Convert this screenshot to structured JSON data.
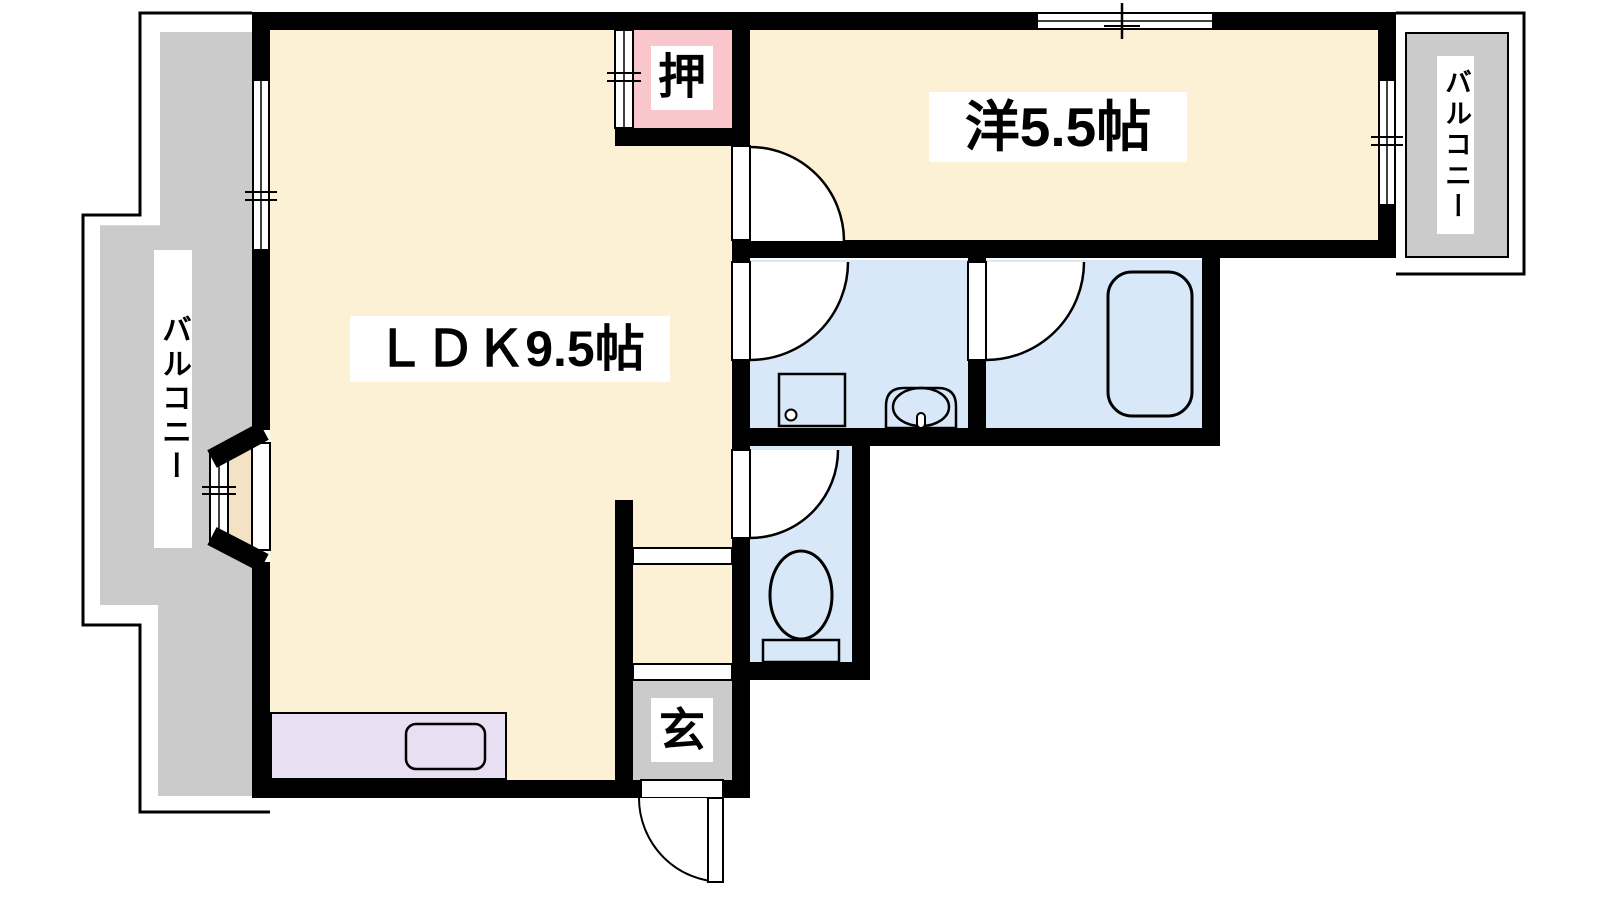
{
  "diagram_type": "japanese-apartment-floor-plan",
  "rooms": {
    "ldk": {
      "label": "ＬＤＫ9.5帖"
    },
    "western_room": {
      "label": "洋5.5帖"
    },
    "closet": {
      "label": "押"
    },
    "entrance": {
      "label": "玄"
    },
    "balcony_left": {
      "label": "バルコニー"
    },
    "balcony_right": {
      "label": "バルコニー"
    }
  },
  "fixtures": [
    "kitchen-counter",
    "kitchen-sink",
    "washing-machine-pan",
    "washbasin",
    "bathtub",
    "toilet",
    "bay-window"
  ],
  "colors": {
    "cream": "#FCF0D5",
    "bay": "#F3E2C3",
    "pink": "#F9C6CB",
    "blue": "#D9E8F8",
    "gray": "#CBCBCB",
    "purple": "#E8DFF3",
    "wall": "#000000"
  }
}
